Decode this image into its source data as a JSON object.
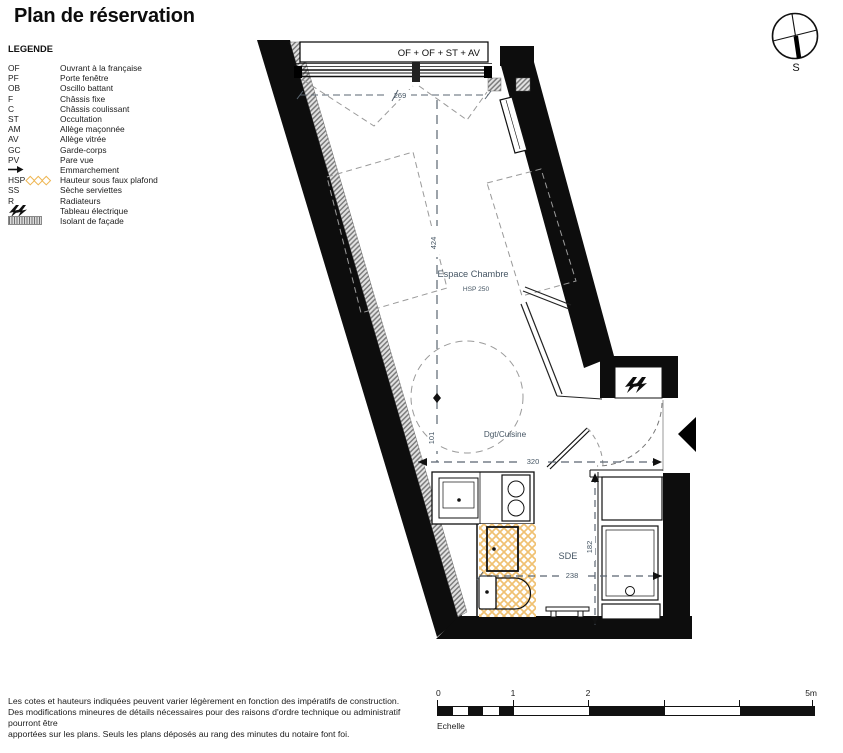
{
  "title": "Plan de réservation",
  "legend": {
    "heading": "LEGENDE",
    "items": [
      {
        "code": "OF",
        "label": "Ouvrant à la française"
      },
      {
        "code": "PF",
        "label": "Porte fenêtre"
      },
      {
        "code": "OB",
        "label": "Oscillo battant"
      },
      {
        "code": "F",
        "label": "Châssis fixe"
      },
      {
        "code": "C",
        "label": "Châssis coulissant"
      },
      {
        "code": "ST",
        "label": "Occultation"
      },
      {
        "code": "AM",
        "label": "Allège maçonnée"
      },
      {
        "code": "AV",
        "label": "Allège vitrée"
      },
      {
        "code": "GC",
        "label": "Garde-corps"
      },
      {
        "code": "PV",
        "label": "Pare vue"
      },
      {
        "icon": "arrow-right-icon",
        "label": "Emmarchement"
      },
      {
        "code": "HSP",
        "icon": "diamond-hatch-icon",
        "label": "Hauteur sous faux plafond"
      },
      {
        "code": "SS",
        "label": "Sèche serviettes"
      },
      {
        "code": "R",
        "label": "Radiateurs"
      },
      {
        "icon": "lightning-icon",
        "label": "Tableau électrique"
      },
      {
        "icon": "facade-insulation-icon",
        "label": "Isolant de façade"
      }
    ]
  },
  "compass": {
    "south_label": "S"
  },
  "plan": {
    "window_label": "OF + OF + ST + AV",
    "rooms": {
      "chambre": "Espace Chambre",
      "chambre_hsp": "HSP 250",
      "cuisine": "Dgt/Cuisine",
      "sde": "SDE"
    },
    "dims": {
      "window_width": "269",
      "chambre_length": "424",
      "circle_offset": "101",
      "cuisine_width": "320",
      "sde_depth": "182",
      "sde_width": "238"
    }
  },
  "scale": {
    "ticks": [
      "0",
      "1",
      "2",
      "5m"
    ],
    "label": "Echelle"
  },
  "disclaimer": {
    "lines": [
      "Les cotes et hauteurs indiquées peuvent varier légèrement en fonction des impératifs de construction.",
      "Des modifications mineures de détails nécessaires pour des raisons d'ordre technique ou administratif pourront être",
      "apportées sur les plans. Seuls les plans déposés au rang des minutes du notaire font foi."
    ]
  },
  "colors": {
    "wall": "#111111",
    "wet_area_hatch": "#f0c172",
    "insulation": "#8a8a8a",
    "dimension_text": "#465664"
  }
}
